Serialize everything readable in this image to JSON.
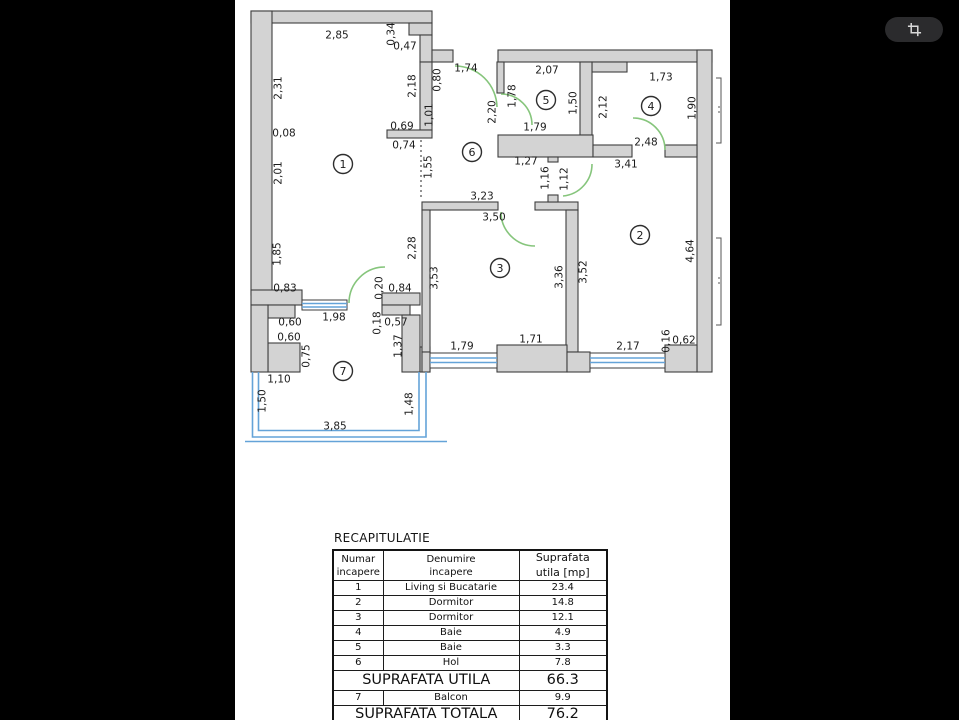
{
  "viewer": {
    "background": "#000000",
    "crop_button": {
      "icon": "crop-icon"
    }
  },
  "page": {
    "background": "#ffffff"
  },
  "floor_plan": {
    "colors": {
      "wall_fill": "#d3d3d3",
      "wall_stroke": "#3e3e3e",
      "door": "#86c57c",
      "window": "#64a3d8",
      "ink": "#1b1b1b"
    },
    "rooms": [
      {
        "n": "1",
        "x": 343,
        "y": 164
      },
      {
        "n": "2",
        "x": 640,
        "y": 235
      },
      {
        "n": "3",
        "x": 500,
        "y": 268
      },
      {
        "n": "4",
        "x": 651,
        "y": 106
      },
      {
        "n": "5",
        "x": 546,
        "y": 100
      },
      {
        "n": "6",
        "x": 472,
        "y": 152
      },
      {
        "n": "7",
        "x": 343,
        "y": 371
      }
    ],
    "dimensions": [
      {
        "t": "2,85",
        "x": 337,
        "y": 35,
        "v": 0
      },
      {
        "t": "0,34",
        "x": 391,
        "y": 34,
        "v": 1
      },
      {
        "t": "0,47",
        "x": 405,
        "y": 46,
        "v": 0
      },
      {
        "t": "2,31",
        "x": 278,
        "y": 88,
        "v": 1
      },
      {
        "t": "0,08",
        "x": 284,
        "y": 133,
        "v": 0
      },
      {
        "t": "2,01",
        "x": 278,
        "y": 173,
        "v": 1
      },
      {
        "t": "1,85",
        "x": 277,
        "y": 254,
        "v": 1
      },
      {
        "t": "0,83",
        "x": 285,
        "y": 288,
        "v": 0
      },
      {
        "t": "2,18",
        "x": 412,
        "y": 86,
        "v": 1
      },
      {
        "t": "0,80",
        "x": 437,
        "y": 80,
        "v": 1
      },
      {
        "t": "1,74",
        "x": 466,
        "y": 68,
        "v": 0
      },
      {
        "t": "1,01",
        "x": 429,
        "y": 115,
        "v": 1
      },
      {
        "t": "0,69",
        "x": 402,
        "y": 126,
        "v": 0
      },
      {
        "t": "0,74",
        "x": 404,
        "y": 145,
        "v": 0
      },
      {
        "t": "1,55",
        "x": 428,
        "y": 167,
        "v": 1
      },
      {
        "t": "2,20",
        "x": 492,
        "y": 112,
        "v": 1
      },
      {
        "t": "1,78",
        "x": 512,
        "y": 96,
        "v": 1
      },
      {
        "t": "2,07",
        "x": 547,
        "y": 70,
        "v": 0
      },
      {
        "t": "1,50",
        "x": 573,
        "y": 103,
        "v": 1
      },
      {
        "t": "1,79",
        "x": 535,
        "y": 127,
        "v": 0
      },
      {
        "t": "2,12",
        "x": 603,
        "y": 107,
        "v": 1
      },
      {
        "t": "1,73",
        "x": 661,
        "y": 77,
        "v": 0
      },
      {
        "t": "1,90",
        "x": 692,
        "y": 108,
        "v": 1
      },
      {
        "t": "2,48",
        "x": 646,
        "y": 142,
        "v": 0
      },
      {
        "t": "3,41",
        "x": 626,
        "y": 164,
        "v": 0
      },
      {
        "t": "1,27",
        "x": 526,
        "y": 161,
        "v": 0
      },
      {
        "t": "1,16",
        "x": 545,
        "y": 178,
        "v": 1
      },
      {
        "t": "1,12",
        "x": 564,
        "y": 179,
        "v": 1
      },
      {
        "t": "3,23",
        "x": 482,
        "y": 196,
        "v": 0
      },
      {
        "t": "3,50",
        "x": 494,
        "y": 217,
        "v": 0
      },
      {
        "t": "2,28",
        "x": 412,
        "y": 248,
        "v": 1
      },
      {
        "t": "3,53",
        "x": 434,
        "y": 278,
        "v": 1
      },
      {
        "t": "3,36",
        "x": 559,
        "y": 277,
        "v": 1
      },
      {
        "t": "3,52",
        "x": 583,
        "y": 272,
        "v": 1
      },
      {
        "t": "4,64",
        "x": 690,
        "y": 251,
        "v": 1
      },
      {
        "t": "0,20",
        "x": 379,
        "y": 288,
        "v": 1
      },
      {
        "t": "0,84",
        "x": 400,
        "y": 288,
        "v": 0
      },
      {
        "t": "1,98",
        "x": 334,
        "y": 317,
        "v": 0
      },
      {
        "t": "0,18",
        "x": 377,
        "y": 323,
        "v": 1
      },
      {
        "t": "0,57",
        "x": 396,
        "y": 322,
        "v": 0
      },
      {
        "t": "0,60",
        "x": 290,
        "y": 322,
        "v": 0
      },
      {
        "t": "0,60",
        "x": 289,
        "y": 337,
        "v": 0
      },
      {
        "t": "0,75",
        "x": 306,
        "y": 356,
        "v": 1
      },
      {
        "t": "1,37",
        "x": 398,
        "y": 346,
        "v": 1
      },
      {
        "t": "1,10",
        "x": 279,
        "y": 379,
        "v": 0
      },
      {
        "t": "1,50",
        "x": 262,
        "y": 401,
        "v": 1
      },
      {
        "t": "1,48",
        "x": 409,
        "y": 404,
        "v": 1
      },
      {
        "t": "3,85",
        "x": 335,
        "y": 426,
        "v": 0
      },
      {
        "t": "1,79",
        "x": 462,
        "y": 346,
        "v": 0
      },
      {
        "t": "1,71",
        "x": 531,
        "y": 339,
        "v": 0
      },
      {
        "t": "2,17",
        "x": 628,
        "y": 346,
        "v": 0
      },
      {
        "t": "0,16",
        "x": 666,
        "y": 341,
        "v": 1
      },
      {
        "t": "0,62",
        "x": 684,
        "y": 340,
        "v": 0
      }
    ]
  },
  "table": {
    "title": "RECAPITULATIE",
    "headers": [
      "Numar\nincapere",
      "Denumire\nincapere",
      "Suprafata\nutila [mp]"
    ],
    "rows": [
      [
        "1",
        "Living si Bucatarie",
        "23.4"
      ],
      [
        "2",
        "Dormitor",
        "14.8"
      ],
      [
        "3",
        "Dormitor",
        "12.1"
      ],
      [
        "4",
        "Baie",
        "4.9"
      ],
      [
        "5",
        "Baie",
        "3.3"
      ],
      [
        "6",
        "Hol",
        "7.8"
      ]
    ],
    "subtotal_label": "SUPRAFATA UTILA",
    "subtotal_value": "66.3",
    "balcony_row": [
      "7",
      "Balcon",
      "9.9"
    ],
    "total_label": "SUPRAFATA TOTALA",
    "total_value": "76.2"
  }
}
